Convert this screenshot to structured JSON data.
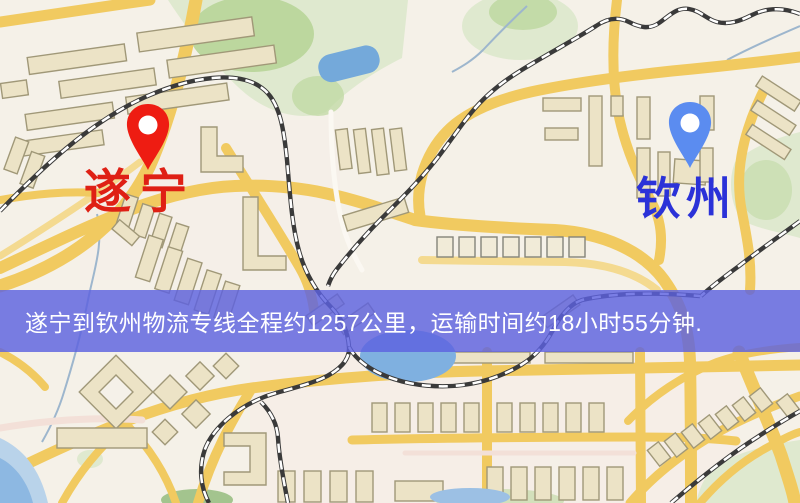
{
  "map": {
    "origin_marker": {
      "icon": "map-pin-icon",
      "label": "遂宁",
      "marker_color": "#ee1c12",
      "label_color": "#df2015"
    },
    "destination_marker": {
      "icon": "map-pin-icon",
      "label": "钦州",
      "marker_color": "#5b8cf0",
      "label_color": "#2b32d8"
    },
    "banner": {
      "text": "遂宁到钦州物流专线全程约1257公里，运输时间约18小时55分钟.",
      "route": "遂宁到钦州物流专线",
      "distance_km": "1257",
      "duration_hours": "18",
      "duration_minutes": "55",
      "background_color": "rgba(93,97,223,0.82)",
      "text_color": "#ffffff"
    },
    "palette": {
      "map_background": "#f5f1e8",
      "road_primary": "#f1ca60",
      "road_minor": "#f4da90",
      "water": "#74a9da",
      "park_green": "#dfe9cf",
      "park_green_bright": "#bcd79e",
      "building_fill": "#ece3c6",
      "building_stroke": "#a09878",
      "railway": "#3a3a3a"
    }
  }
}
